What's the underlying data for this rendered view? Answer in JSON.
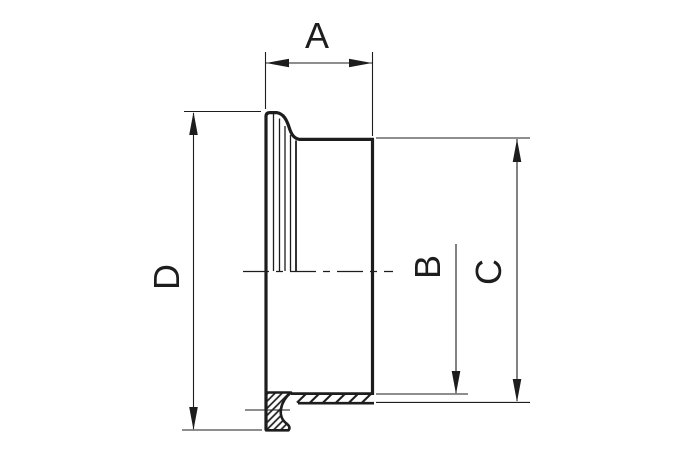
{
  "drawing": {
    "background": "#ffffff",
    "line_color": "#1d1d1d",
    "labels": {
      "a": "A",
      "b": "B",
      "c": "C",
      "d": "D"
    }
  }
}
